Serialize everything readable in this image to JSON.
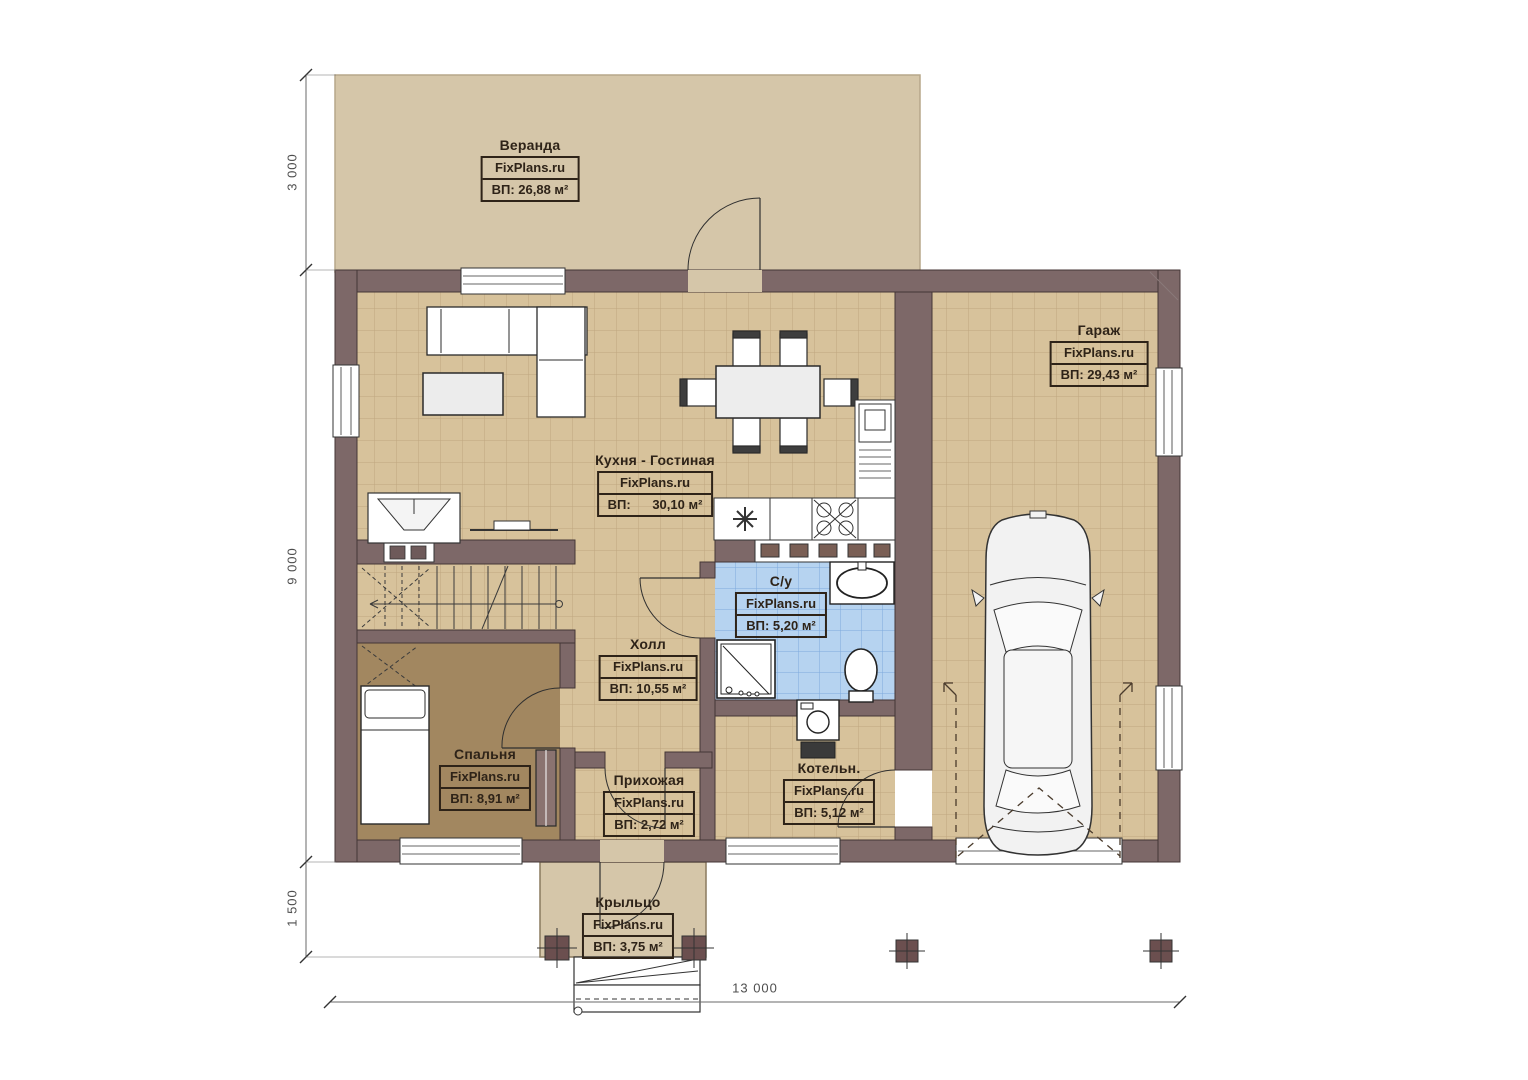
{
  "site_label": "FixPlans.ru",
  "rooms": [
    {
      "id": "veranda",
      "name": "Веранда",
      "area": "ВП: 26,88 м²"
    },
    {
      "id": "garage",
      "name": "Гараж",
      "area": "ВП: 29,43 м²"
    },
    {
      "id": "kitchen_living",
      "name": "Кухня - Гостиная",
      "area": "ВП:      30,10 м²"
    },
    {
      "id": "bathroom",
      "name": "С/у",
      "area": "ВП: 5,20 м²"
    },
    {
      "id": "hall",
      "name": "Холл",
      "area": "ВП: 10,55 м²"
    },
    {
      "id": "bedroom",
      "name": "Спальня",
      "area": "ВП: 8,91 м²"
    },
    {
      "id": "entry",
      "name": "Прихожая",
      "area": "ВП: 2,72 м²"
    },
    {
      "id": "boiler",
      "name": "Котельн.",
      "area": "ВП: 5,12 м²"
    },
    {
      "id": "porch",
      "name": "Крыльцо",
      "area": "ВП: 3,75 м²"
    }
  ],
  "dimensions": {
    "left_top": "3 000",
    "left_middle": "9 000",
    "left_bottom": "1 500",
    "bottom_width": "13 000"
  },
  "colors": {
    "wall": "#7d6868",
    "floor_tile": "#d7c29b",
    "veranda": "#d5c6a9",
    "bedroom_floor": "#a28760",
    "bathroom_tile": "#b6d3f0"
  }
}
